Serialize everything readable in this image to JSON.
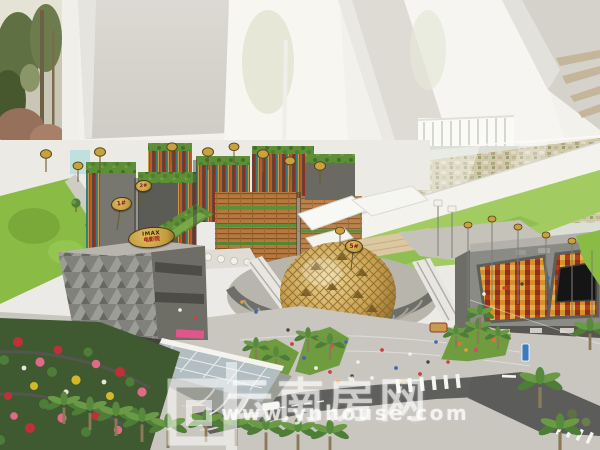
{
  "model_signs": {
    "sign_1": "1#",
    "sign_2": "2#",
    "sign_5": "5#",
    "imax_line1": "IMAX",
    "imax_line2": "电影院"
  },
  "watermark": {
    "site_name": "云南房网",
    "site_url": "www.ynhouse.com",
    "logo_icon": "ynhouse-square-logo",
    "color": "#ffffff"
  },
  "colors": {
    "concrete_wall": "#d8d5cf",
    "lawn_green": "#8abb44",
    "dome_gold": "#c9a050",
    "copper_facade": "#b5793f",
    "mosaic_orange": "#c1561e",
    "asphalt_road": "#5f5f5d",
    "plaza_paving": "#c9c6bf",
    "flower_red": "#c03038",
    "flower_pink": "#e06a88"
  }
}
